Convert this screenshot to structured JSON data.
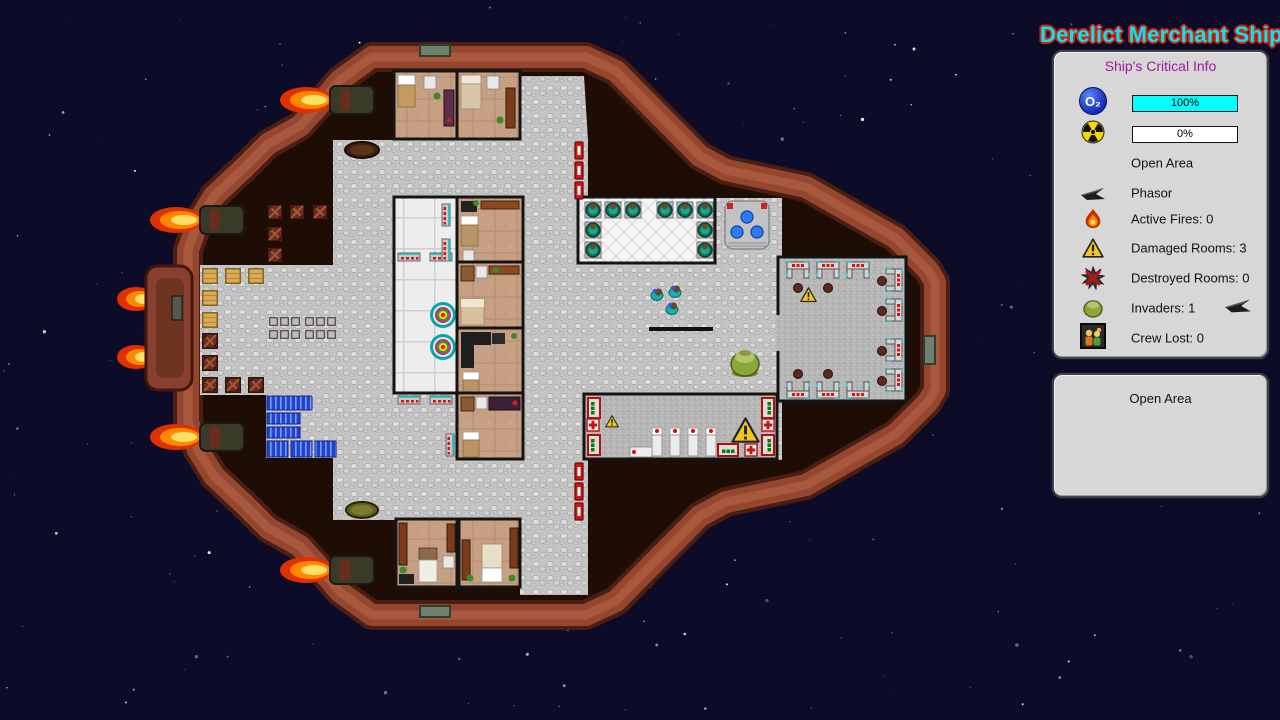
{
  "header": {
    "title": "Derelict Merchant Ship"
  },
  "critical_info_panel": {
    "heading": "Ship's Critical Info",
    "oxygen": {
      "symbol": "O₂",
      "value": "100%",
      "percent": 100,
      "bar_color": "#00ffff"
    },
    "radiation": {
      "value": "0%",
      "percent": 0,
      "bar_color": "#ffffff"
    },
    "selected_area_label": "Open Area",
    "weapon_label": "Phasor",
    "stats": [
      {
        "icon": "fire-icon",
        "label": "Active Fires: 0"
      },
      {
        "icon": "warning-icon",
        "label": "Damaged Rooms: 3"
      },
      {
        "icon": "destroyed-icon",
        "label": "Destroyed Rooms: 0"
      },
      {
        "icon": "invader-icon",
        "label": "Invaders: 1",
        "trailing_icon": "phasor-icon"
      },
      {
        "icon": "crew-lost-icon",
        "label": "Crew Lost: 0"
      }
    ]
  },
  "hover_panel": {
    "label": "Open Area"
  },
  "colors": {
    "title_fill": "#00e6f2",
    "title_outline": "#d42410",
    "heading_text": "#a118a1",
    "panel_bg": "#d7d7d7",
    "space_bg": "#0c0c28",
    "hull": "#94462e",
    "o2_bar_fill": "#00ffff",
    "radiation_bar_fill": "#ffffff"
  }
}
